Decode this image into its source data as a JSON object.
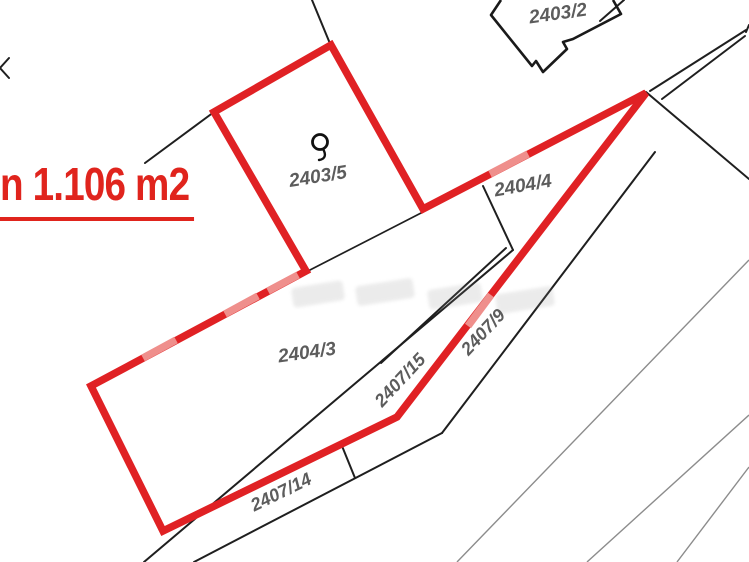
{
  "highlight": {
    "area_text": "n 1.106 m2"
  },
  "parcels": {
    "p2403_2": {
      "label": "2403/2"
    },
    "p2403_5": {
      "label": "2403/5"
    },
    "p2404_4": {
      "label": "2404/4"
    },
    "p2404_3": {
      "label": "2404/3"
    },
    "p2407_15": {
      "label": "2407/15"
    },
    "p2407_9": {
      "label": "2407/9"
    },
    "p2407_14": {
      "label": "2407/14"
    }
  },
  "symbols": {
    "land_use_symbol_parcel": "2403/5"
  },
  "colors": {
    "highlight_red": "#e02124",
    "boundary_black": "#1f1f1f",
    "label_gray": "#5c5c5c",
    "railway_gray": "#8c8c8c",
    "background": "#ffffff"
  }
}
